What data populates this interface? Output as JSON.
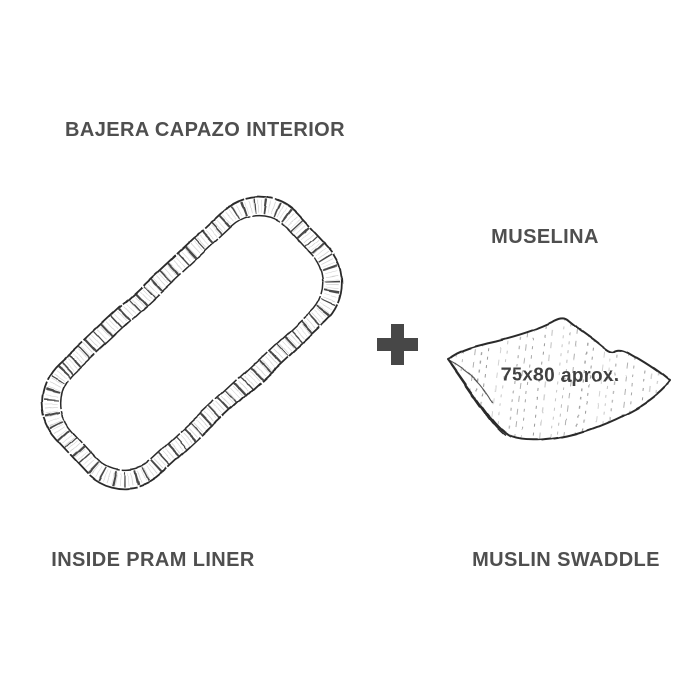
{
  "diagram": {
    "left_item": {
      "title_es": "BAJERA CAPAZO INTERIOR",
      "title_en": "INSIDE PRAM LINER"
    },
    "right_item": {
      "title_es": "MUSELINA",
      "title_en": "MUSLIN SWADDLE",
      "size_note": "75x80 aprox."
    },
    "icons": {
      "separator": "plus-icon"
    },
    "colors": {
      "background": "#ffffff",
      "label_text": "#4f4f4f",
      "size_text": "#3f3f3f",
      "plus": "#474747",
      "sketch_outline": "#2a2a2a",
      "sketch_texture": "#8f8f8f"
    }
  }
}
